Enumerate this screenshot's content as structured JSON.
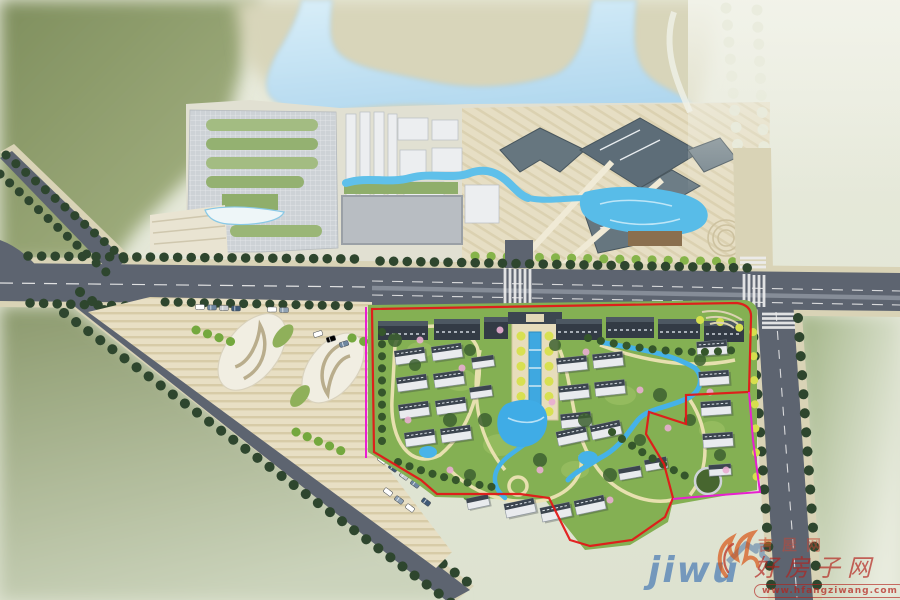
{
  "watermarks": {
    "jiwu": {
      "latin": "jiwu",
      "cn": "吉屋网"
    },
    "hfangziwang": {
      "site_name_cn": "好房子网",
      "brand_cn_outline": "吉屋网",
      "url": "www.hfangziwang.com"
    }
  },
  "palette": {
    "background_olive": "#87966b",
    "background_pale": "#e4e7d7",
    "land_tan": "#d8d5ba",
    "lake_blue": "#bfdef2",
    "road_asphalt": "#5d6470",
    "sidewalk_beige": "#d9d3b6",
    "road_marking": "#eeeeee",
    "tree_dark": "#2e462e",
    "tree_bright": "#74a83e",
    "tree_yellow": "#d6df4e",
    "flower_pink": "#e9aed2",
    "greenland": "#84b053",
    "canopy_dark": "#3d6130",
    "path_cream": "#ede3b4",
    "stream_blue": "#45b2e8",
    "water_feature": "#3fa8e0",
    "plaza_paving": "#e8dfc4",
    "building_white": "#e9ebee",
    "building_roof_dark": "#3c454f",
    "commercial_roof_slate": "#66767f",
    "boundary_red": "#e11818",
    "boundary_magenta": "#e81fd0",
    "watermark_blue": "#1e5cac",
    "watermark_red": "#b4221c",
    "watermark_orange": "#e07818"
  }
}
